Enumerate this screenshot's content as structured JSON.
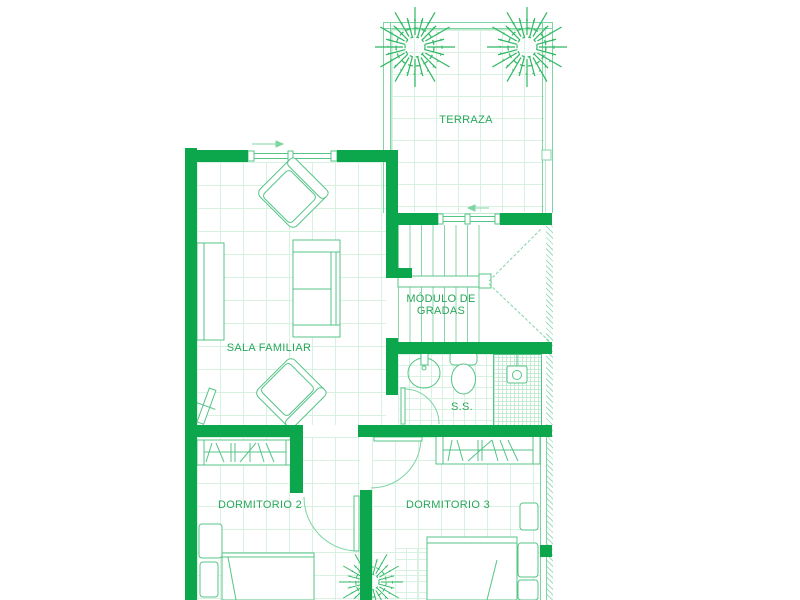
{
  "plan": {
    "title": "floor-plan-second-level",
    "labels": {
      "terraza": "TERRAZA",
      "gradas_line1": "MÓDULO DE",
      "gradas_line2": "GRADAS",
      "sala": "SALA FAMILIAR",
      "bano": "S.S.",
      "dorm2": "DORMITORIO 2",
      "dorm3": "DORMITORIO 3"
    },
    "colors": {
      "wall_green": "#0ca64c",
      "furniture_line_green": "#55c487",
      "light_line_green": "#7fd4a4",
      "grid_green": "#d8f2e2",
      "text_green": "#2aa65c",
      "plant_green": "#2eb862"
    }
  }
}
